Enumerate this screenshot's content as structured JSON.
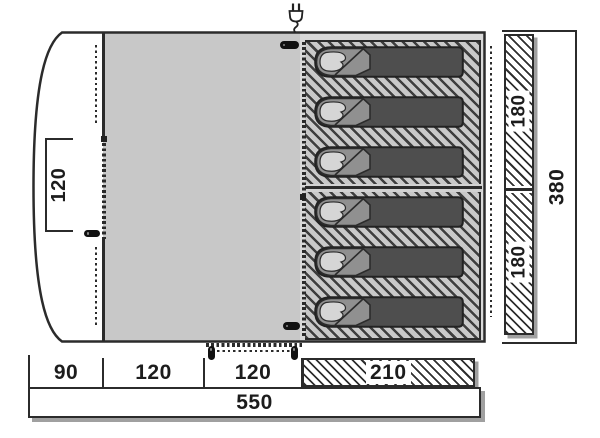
{
  "diagram": {
    "kind": "tent-floorplan-top-view",
    "dimensions": {
      "door_width": "120",
      "sleeping_section_depths": [
        "180",
        "180"
      ],
      "total_depth": "380",
      "bottom_segments": [
        "90",
        "120",
        "120",
        "210"
      ],
      "total_length": "550"
    },
    "sleeping": {
      "bag_count": 6,
      "compartments": 2,
      "bags_per_compartment": 3
    },
    "icons": {
      "power": "power-plug-icon",
      "zipper_pull": "zipper-pull-icon",
      "zipper_teeth": "zipper-teeth-line"
    },
    "colors": {
      "outline": "#2b2b2b",
      "living_floor": "#c8c8c8",
      "inner_tent_frame": "#d9d9d9",
      "hatch_stripe": "#3e3e3e",
      "sleeping_bag_body": "#4e4e4e",
      "sleeping_bag_flap": "#909090",
      "pillow": "#d6d6d6",
      "shadow": "#a0a0a0"
    }
  }
}
